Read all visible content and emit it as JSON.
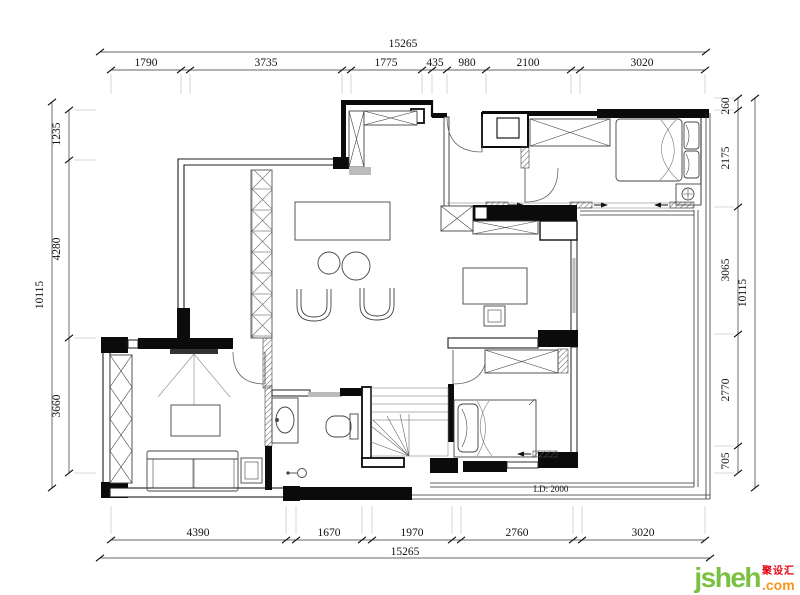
{
  "plan": {
    "scale_note": "LD: 2000"
  },
  "dimensions": {
    "top": {
      "overall": "15265",
      "segments": [
        "1790",
        "3735",
        "1775",
        "435",
        "980",
        "2100",
        "3020"
      ]
    },
    "bottom": {
      "overall": "15265",
      "segments": [
        "4390",
        "1670",
        "1970",
        "2760",
        "3020"
      ]
    },
    "left": {
      "overall": "10115",
      "segments": [
        "1235",
        "4280",
        "3660"
      ]
    },
    "right": {
      "overall": "10115",
      "segments": [
        "260",
        "2175",
        "3065",
        "2770",
        "705"
      ]
    }
  },
  "watermark": {
    "brand": "jsheh",
    "tld": ".com",
    "cn_name": "聚设汇"
  },
  "colors": {
    "line": "#1c1c1c",
    "wall_fill": "#0b0b0b",
    "logo_green": "#7ac143",
    "logo_orange": "#f7941d",
    "logo_red": "#e60012"
  }
}
